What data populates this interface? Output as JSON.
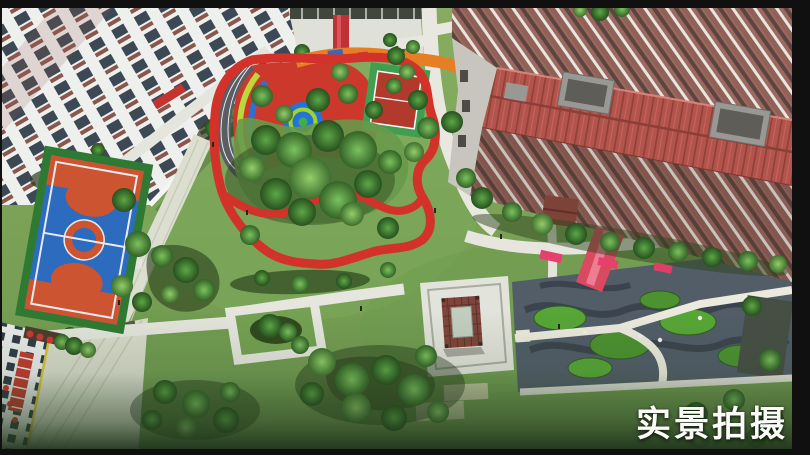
{
  "caption": {
    "text": "实景拍摄"
  },
  "photo": {
    "subject": "aerial-view-residential-courtyard",
    "colors": {
      "frame_black": "#101010",
      "lawn_green": "#7aa155",
      "track_red": "#d2322a",
      "path_white": "#e6e6de",
      "playground_red": "#cc392c",
      "playground_orange": "#e67e26",
      "playground_blue": "#2573d8",
      "playground_lime": "#b9d93c",
      "basketball_blue": "#2c6bbd",
      "basketball_orange": "#cd5430",
      "tennis_green": "#3f9e4f",
      "tennis_red": "#b23a2c",
      "roof_red": "#b2544c",
      "brick_facade": "#91635a",
      "pavilion_roof": "#7c4038",
      "garden_slate": "#525d68",
      "hedge_green": "#4e9a33",
      "carpet_pink": "#e8406e",
      "caption_color": "#fbfbf7"
    }
  }
}
